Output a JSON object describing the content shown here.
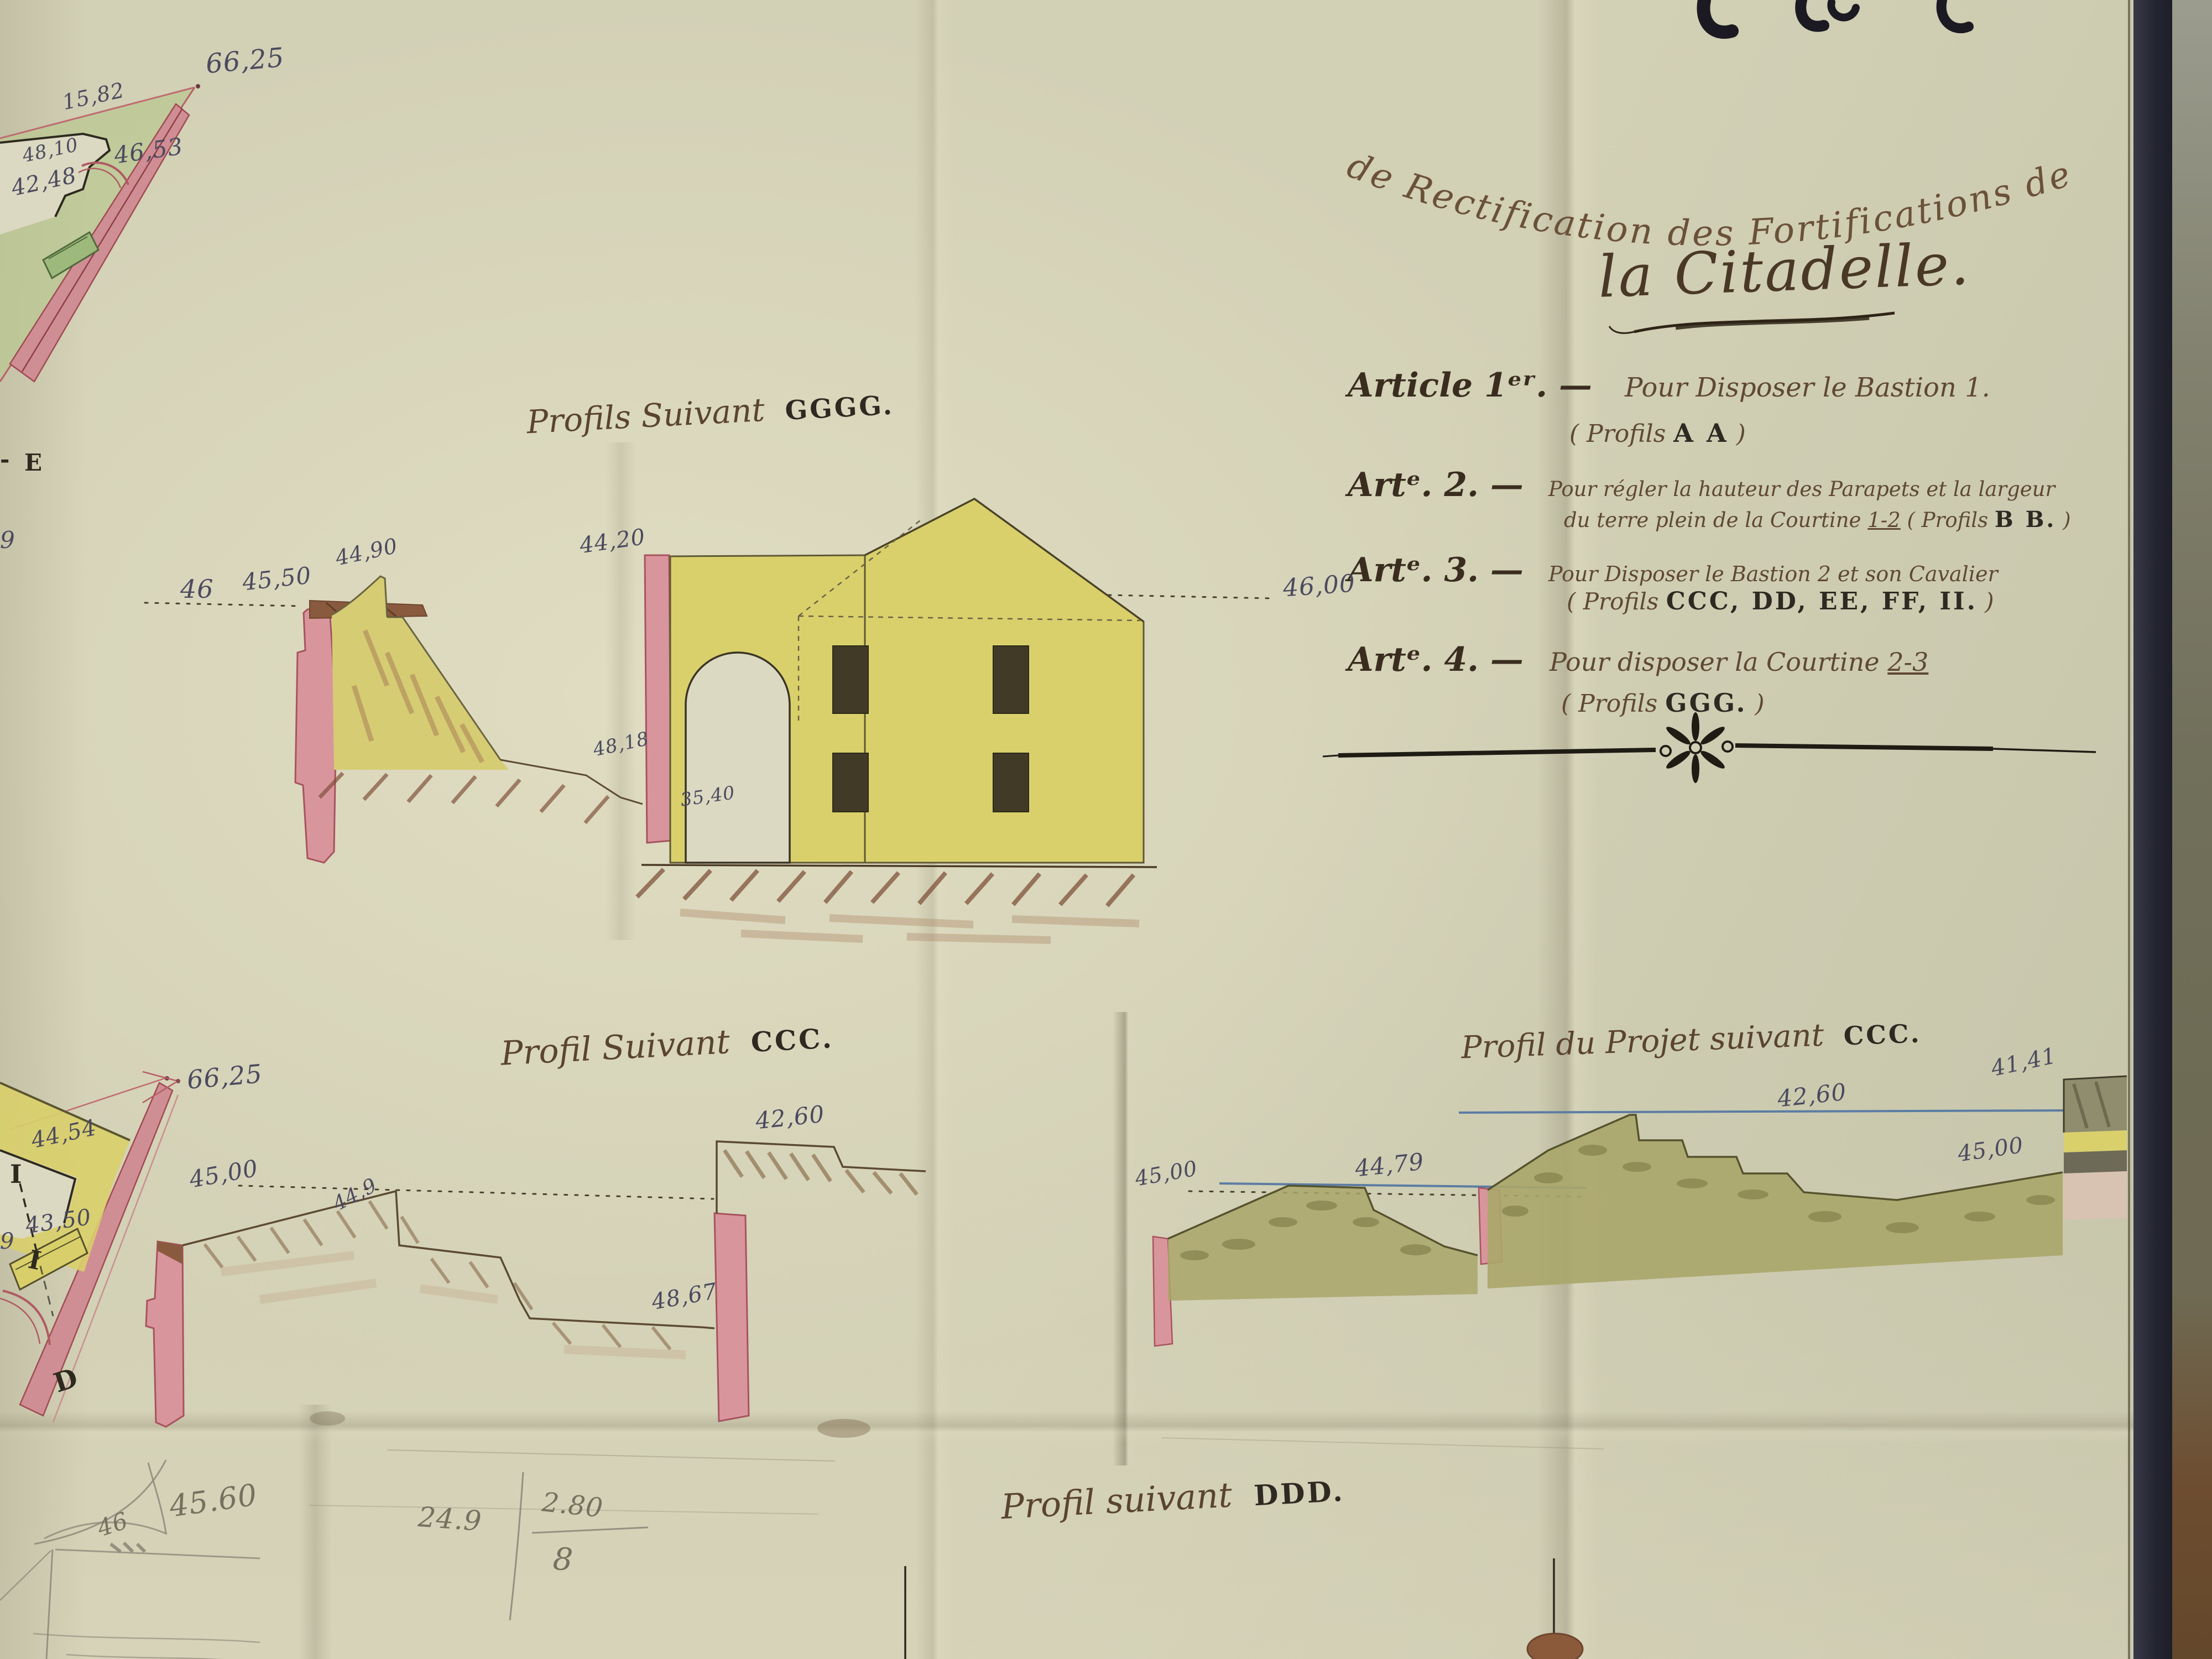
{
  "title": {
    "line1": "de Rectification des Fortifications de",
    "line2": "la Citadelle."
  },
  "articles": [
    {
      "label": "Article 1ᵉʳ. —",
      "line1": "Pour Disposer le Bastion 1.",
      "line2_pre": "( Profils ",
      "line2_caps": "A A",
      "line2_post": " )"
    },
    {
      "label": "Artᵉ. 2. —",
      "line1": "Pour régler la hauteur des Parapets et la largeur",
      "line2_pre": "du terre plein de la Courtine ",
      "line2_ref": "1-2",
      "line2_mid": " ( Profils ",
      "line2_caps": "B B.",
      "line2_post": " )"
    },
    {
      "label": "Artᵉ. 3. —",
      "line1": "Pour Disposer le Bastion 2 et son Cavalier",
      "line2_pre": "( Profils ",
      "line2_caps": "CCC, DD, EE, FF, II.",
      "line2_post": " )"
    },
    {
      "label": "Artᵉ. 4. —",
      "line1": "Pour disposer la Courtine ",
      "line1_ref": "2-3",
      "line2_pre": "( Profils ",
      "line2_caps": "GGG.",
      "line2_post": " )"
    }
  ],
  "profiles": {
    "ggg": {
      "pre": "Profils Suivant",
      "caps": "GGGG."
    },
    "ccc": {
      "pre": "Profil Suivant",
      "caps": "CCC."
    },
    "ccc_projet": {
      "pre": "Profil du Projet suivant",
      "caps": "CCC."
    },
    "ddd": {
      "pre": "Profil suivant",
      "caps": "DDD."
    }
  },
  "measures": {
    "ggg": {
      "m46": "46",
      "m4550": "45,50",
      "m4490": "44,90",
      "m4420": "44,20",
      "m4818": "48,18",
      "m3540": "35,40",
      "m4600": "46,00"
    },
    "ccc": {
      "m6625": "66,25",
      "m4500": "45,00",
      "m449": "44,9",
      "m4867": "48,67",
      "m4260": "42,60"
    },
    "ccc_projet": {
      "m4500": "45,00",
      "m4479": "44,79",
      "m4260": "42,60",
      "m4141": "41,41",
      "m4500b": "45,00"
    },
    "map_top_left": {
      "m6625": "66,25",
      "m1582": "15,82",
      "m4810": "48,10",
      "m4653": "46,53",
      "m4248": "42,48"
    },
    "map_mid_left": {
      "m4454": "44,54",
      "m4350": "43,50",
      "i1": "I",
      "i2": "I",
      "d": "D",
      "n9": "9"
    }
  },
  "letters": {
    "e": "E",
    "dash": "-",
    "n9": "9"
  },
  "pencil": {
    "p4560": "45.60",
    "p46": "46",
    "p249": "24.9",
    "p280": "2.80",
    "p8": "8"
  },
  "colors": {
    "paper": "#d2d0b5",
    "ink": "#5a4331",
    "measure_ink": "#4b4a5e",
    "pink_wash": "#d9959c",
    "yellow_wash": "#d9d06c",
    "olive_wash": "#a8a468",
    "brown_earth": "#7b4a33",
    "blue_line": "#5b7ca3",
    "cover_navy": "#232430"
  }
}
